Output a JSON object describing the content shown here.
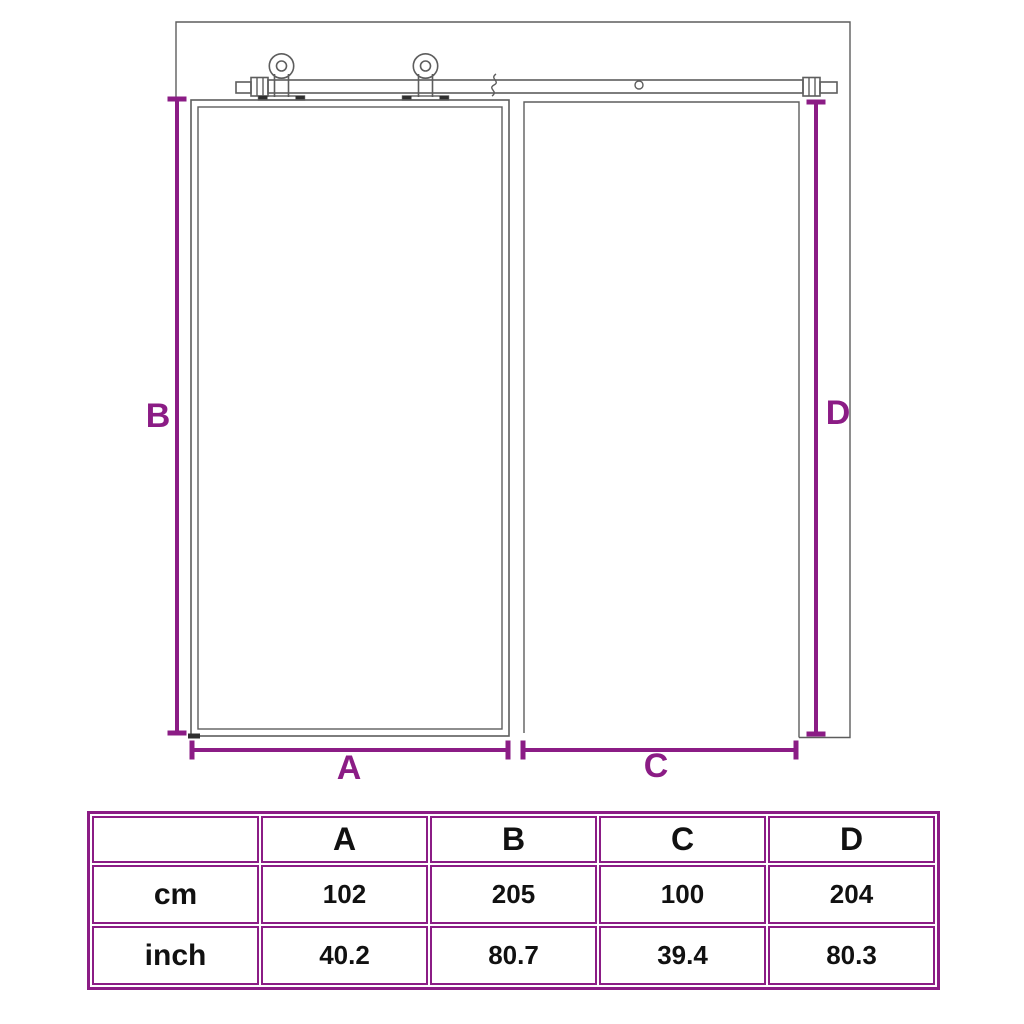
{
  "colors": {
    "accent": "#8B1C85",
    "line": "#5d5d5d",
    "text": "#111111",
    "background": "#ffffff"
  },
  "diagram": {
    "kind": "sliding-barn-door-dimension-drawing",
    "labels": {
      "a": "A",
      "b": "B",
      "c": "C",
      "d": "D"
    }
  },
  "table": {
    "corner": "",
    "headers": [
      "A",
      "B",
      "C",
      "D"
    ],
    "rows": [
      {
        "label": "cm",
        "values": [
          "102",
          "205",
          "100",
          "204"
        ]
      },
      {
        "label": "inch",
        "values": [
          "40.2",
          "80.7",
          "39.4",
          "80.3"
        ]
      }
    ]
  }
}
